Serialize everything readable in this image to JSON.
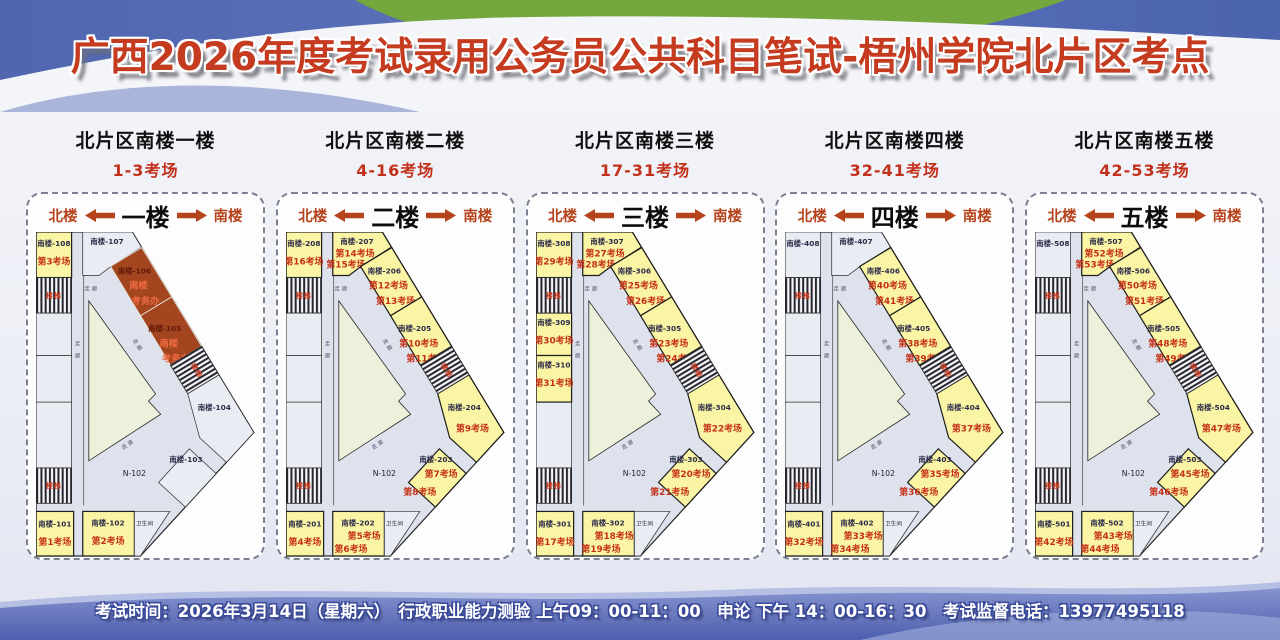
{
  "title": "广西2026年度考试录用公务员公共科目笔试-梧州学院北片区考点",
  "footer": {
    "text": "考试时间：2026年3月14日（星期六）　行政职业能力测验 上午09：00-11：00　申论 下午 14：00-16：30　考试监督电话：13977495118"
  },
  "plan_labels": {
    "corridor": "走廊",
    "toilet": "卫生间",
    "stairs": "楼梯",
    "open_area": "N-102"
  },
  "colors": {
    "exam_room_fill": "#faf4a5",
    "office_room_fill": "#a3461f",
    "plain_room_fill": "#e9ecf2",
    "corridor_fill": "#dee2ec",
    "courtyard_fill": "#edf0da",
    "accent_red": "#c2311c",
    "nav_red": "#b5431c",
    "header_blue": "#5468b0",
    "header_green": "#74a73e",
    "footer_blue": "#5d6fb8"
  },
  "floors": [
    {
      "name": "北片区南楼一楼",
      "range": "1-3考场",
      "floor_label": "一楼",
      "nav_left": "北楼",
      "nav_right": "南楼",
      "rooms": {
        "tl": {
          "num": "南楼-108",
          "lines": [
            "第3考场"
          ],
          "style": "exam"
        },
        "top": {
          "num": "南楼-107",
          "lines": [],
          "style": "plain"
        },
        "w1": {
          "num": "南楼-106",
          "lines": [
            "南楼",
            "考务办"
          ],
          "style": "office"
        },
        "w2": {
          "num": "南楼-105",
          "lines": [
            "南楼",
            "考务办"
          ],
          "style": "office"
        },
        "w3": {
          "num": "南楼-104",
          "lines": [],
          "style": "plain"
        },
        "w4": {
          "num": "南楼-103",
          "lines": [],
          "style": "plain"
        },
        "bl": {
          "num": "南楼-101",
          "lines": [
            "第1考场"
          ],
          "style": "exam"
        },
        "bm": {
          "num": "南楼-102",
          "lines": [
            "第2考场"
          ],
          "style": "exam"
        }
      }
    },
    {
      "name": "北片区南楼二楼",
      "range": "4-16考场",
      "floor_label": "二楼",
      "nav_left": "北楼",
      "nav_right": "南楼",
      "rooms": {
        "tl": {
          "num": "南楼-208",
          "lines": [
            "第16考场"
          ],
          "style": "exam"
        },
        "top": {
          "num": "南楼-207",
          "lines": [
            "第14考场",
            "第15考场"
          ],
          "style": "exam"
        },
        "w1": {
          "num": "南楼-206",
          "lines": [
            "第12考场",
            "第13考场"
          ],
          "style": "exam"
        },
        "w2": {
          "num": "南楼-205",
          "lines": [
            "第10考场",
            "第11考场"
          ],
          "style": "exam"
        },
        "w3": {
          "num": "南楼-204",
          "lines": [
            "第9考场"
          ],
          "style": "exam"
        },
        "w4": {
          "num": "南楼-203",
          "lines": [
            "第7考场",
            "第8考场"
          ],
          "style": "exam"
        },
        "bl": {
          "num": "南楼-201",
          "lines": [
            "第4考场"
          ],
          "style": "exam"
        },
        "bm": {
          "num": "南楼-202",
          "lines": [
            "第5考场",
            "第6考场"
          ],
          "style": "exam"
        }
      }
    },
    {
      "name": "北片区南楼三楼",
      "range": "17-31考场",
      "floor_label": "三楼",
      "nav_left": "北楼",
      "nav_right": "南楼",
      "rooms": {
        "tl": {
          "num": "南楼-308",
          "lines": [
            "第29考场"
          ],
          "style": "exam"
        },
        "la": {
          "num": "南楼-309",
          "lines": [
            "第30考场"
          ],
          "style": "exam"
        },
        "lb": {
          "num": "南楼-310",
          "lines": [
            "第31考场"
          ],
          "style": "exam"
        },
        "top": {
          "num": "南楼-307",
          "lines": [
            "第27考场",
            "第28考场"
          ],
          "style": "exam"
        },
        "w1": {
          "num": "南楼-306",
          "lines": [
            "第25考场",
            "第26考场"
          ],
          "style": "exam"
        },
        "w2": {
          "num": "南楼-305",
          "lines": [
            "第23考场",
            "第24考场"
          ],
          "style": "exam"
        },
        "w3": {
          "num": "南楼-304",
          "lines": [
            "第22考场"
          ],
          "style": "exam"
        },
        "w4": {
          "num": "南楼-303",
          "lines": [
            "第20考场",
            "第21考场"
          ],
          "style": "exam"
        },
        "bl": {
          "num": "南楼-301",
          "lines": [
            "第17考场"
          ],
          "style": "exam"
        },
        "bm": {
          "num": "南楼-302",
          "lines": [
            "第18考场",
            "第19考场"
          ],
          "style": "exam"
        }
      }
    },
    {
      "name": "北片区南楼四楼",
      "range": "32-41考场",
      "floor_label": "四楼",
      "nav_left": "北楼",
      "nav_right": "南楼",
      "rooms": {
        "tl": {
          "num": "南楼-408",
          "lines": [],
          "style": "plain"
        },
        "top": {
          "num": "南楼-407",
          "lines": [],
          "style": "plain"
        },
        "w1": {
          "num": "南楼-406",
          "lines": [
            "第40考场",
            "第41考场"
          ],
          "style": "exam"
        },
        "w2": {
          "num": "南楼-405",
          "lines": [
            "第38考场",
            "第39考场"
          ],
          "style": "exam"
        },
        "w3": {
          "num": "南楼-404",
          "lines": [
            "第37考场"
          ],
          "style": "exam"
        },
        "w4": {
          "num": "南楼-403",
          "lines": [
            "第35考场",
            "第36考场"
          ],
          "style": "exam"
        },
        "bl": {
          "num": "南楼-401",
          "lines": [
            "第32考场"
          ],
          "style": "exam"
        },
        "bm": {
          "num": "南楼-402",
          "lines": [
            "第33考场",
            "第34考场"
          ],
          "style": "exam"
        }
      }
    },
    {
      "name": "北片区南楼五楼",
      "range": "42-53考场",
      "floor_label": "五楼",
      "nav_left": "北楼",
      "nav_right": "南楼",
      "rooms": {
        "tl": {
          "num": "南楼-508",
          "lines": [],
          "style": "plain"
        },
        "top": {
          "num": "南楼-507",
          "lines": [
            "第52考场",
            "第53考场"
          ],
          "style": "exam"
        },
        "w1": {
          "num": "南楼-506",
          "lines": [
            "第50考场",
            "第51考场"
          ],
          "style": "exam"
        },
        "w2": {
          "num": "南楼-505",
          "lines": [
            "第48考场",
            "第49考场"
          ],
          "style": "exam"
        },
        "w3": {
          "num": "南楼-504",
          "lines": [
            "第47考场"
          ],
          "style": "exam"
        },
        "w4": {
          "num": "南楼-503",
          "lines": [
            "第45考场",
            "第46考场"
          ],
          "style": "exam"
        },
        "bl": {
          "num": "南楼-501",
          "lines": [
            "第42考场"
          ],
          "style": "exam"
        },
        "bm": {
          "num": "南楼-502",
          "lines": [
            "第43考场",
            "第44考场"
          ],
          "style": "exam"
        }
      }
    }
  ]
}
